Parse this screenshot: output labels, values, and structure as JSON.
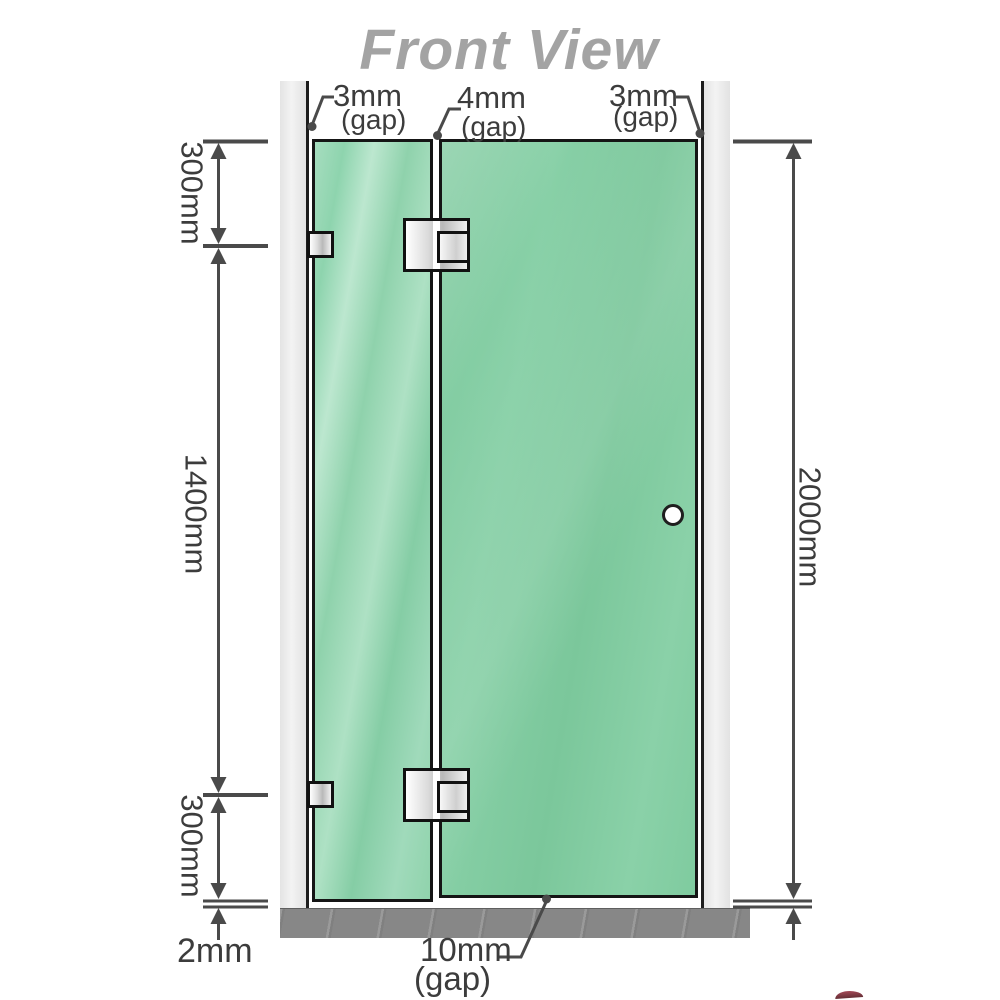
{
  "diagram": {
    "title": "Front View",
    "labels": {
      "gap_top_left_value": "3mm",
      "gap_top_left_unit": "(gap)",
      "gap_top_mid_value": "4mm",
      "gap_top_mid_unit": "(gap)",
      "gap_top_right_value": "3mm",
      "gap_top_right_unit": "(gap)",
      "dim_top": "300mm",
      "dim_mid": "1400mm",
      "dim_bottom": "300mm",
      "dim_total_height": "2000mm",
      "floor_clearance": "2mm",
      "gap_bottom_value": "10mm",
      "gap_bottom_unit": "(gap)"
    },
    "colors": {
      "glass_green_fixed": "#9ad8b5",
      "glass_green_door": "#7fca9f",
      "wall_gray": "#ececec",
      "floor_gray": "#878787",
      "line_gray": "#4a4a4a",
      "title_gray": "#a3a3a3",
      "hinge_silver": "#d9d9d9"
    }
  }
}
